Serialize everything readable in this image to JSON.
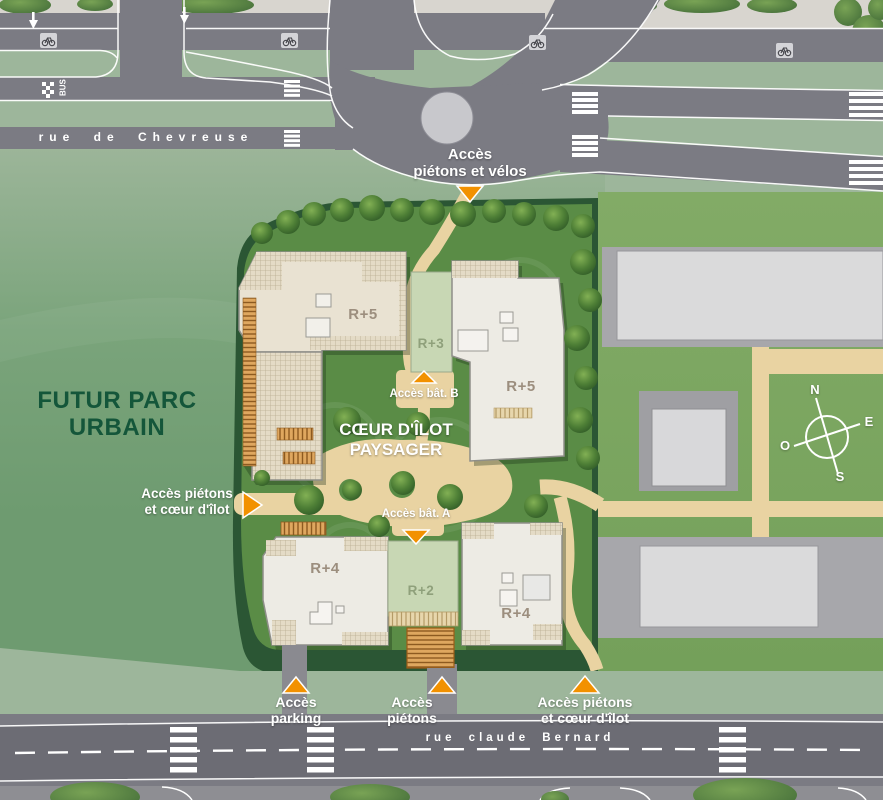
{
  "streets": {
    "chevreuse": "rue de Chevreuse",
    "bernard": "rue claude Bernard"
  },
  "bus_stop_label": "BUS",
  "park_label": "FUTUR PARC\nURBAIN",
  "heart_label": "CŒUR D'ÎLOT\nPAYSAGER",
  "access": {
    "top": "Accès\npiétons et vélos",
    "west": "Accès piétons\net cœur d'îlot",
    "bat_b": "Accès bât. B",
    "bat_a": "Accès bât. A",
    "parking": "Accès\nparking",
    "pietons": "Accès\npiétons",
    "southeast": "Accès piétons\net cœur d'îlot"
  },
  "buildings": {
    "northwest": "R+5",
    "north_wing": "R+3",
    "northeast": "R+5",
    "southwest": "R+4",
    "south_wing": "R+2",
    "southeast": "R+4"
  },
  "compass": {
    "north": "N",
    "east": "E",
    "west": "O",
    "south": "S"
  },
  "colors": {
    "accent_orange": "#F29100",
    "park_green": "#6E9B70",
    "site_lawn_green": "#5A8C46",
    "hedge_green": "#2B5634",
    "road_gray": "#7B7B83",
    "path_beige": "#E9D3A2",
    "building_cream": "#E9E2D2",
    "sage_sidewalk": "#9DB69B",
    "dark_green_text": "#14563A"
  }
}
